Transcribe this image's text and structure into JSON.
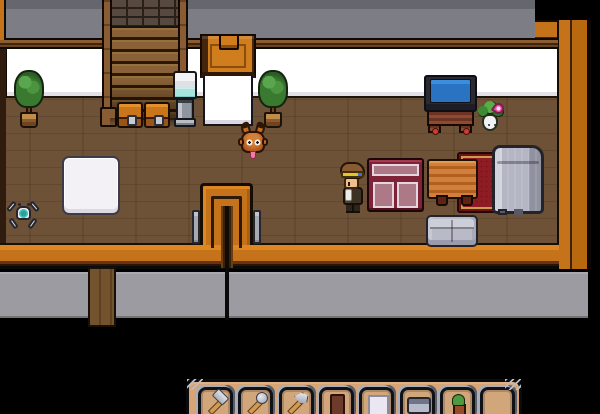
{
  "palette": {
    "void": "#000000",
    "gray_wall_top": "#7d7d85",
    "gray_wall_bottom": "#9b9ba1",
    "orange_wall": "#c4731a",
    "orange_bright": "#de8722",
    "trim_brown": "#6a4523",
    "wall_white": "#ffffff",
    "floor_brown": "#6e5237",
    "tv_screen_blue": "#2a72c2",
    "rug_red": "#8e1c22",
    "rug_gold": "#c99c4e",
    "counter_maroon": "#7f2336",
    "furniture_gray": "#b4b6c4"
  },
  "scene": {
    "objects": [
      {
        "name": "white-rug",
        "type": "white-rug",
        "x": 62,
        "y": 156,
        "w": 58,
        "h": 59,
        "interactable": false
      },
      {
        "name": "red-rug",
        "type": "red-rug",
        "x": 457,
        "y": 152,
        "w": 83,
        "h": 61,
        "interactable": false
      },
      {
        "name": "staircase",
        "type": "stairs",
        "x": 102,
        "y": 0,
        "w": 86,
        "h": 127,
        "interactable": true
      },
      {
        "name": "chest-1",
        "type": "chest",
        "x": 117,
        "y": 102,
        "w": 26,
        "h": 26,
        "interactable": true
      },
      {
        "name": "chest-2",
        "type": "chest",
        "x": 144,
        "y": 102,
        "w": 26,
        "h": 26,
        "interactable": true
      },
      {
        "name": "potted-plant-left",
        "type": "potted-plant",
        "x": 14,
        "y": 70,
        "w": 30,
        "h": 58,
        "interactable": false
      },
      {
        "name": "water-cooler",
        "type": "water-cooler",
        "x": 172,
        "y": 71,
        "w": 26,
        "h": 56,
        "interactable": true
      },
      {
        "name": "north-door",
        "type": "door-top",
        "x": 200,
        "y": 34,
        "w": 56,
        "h": 44,
        "interactable": true
      },
      {
        "name": "dividing-wall-stub",
        "type": "wall-stub",
        "x": 203,
        "y": 76,
        "w": 50,
        "h": 50,
        "interactable": false
      },
      {
        "name": "potted-plant-middle",
        "type": "potted-plant",
        "x": 258,
        "y": 70,
        "w": 30,
        "h": 58,
        "interactable": false
      },
      {
        "name": "television-stand",
        "type": "tv-stand",
        "x": 424,
        "y": 75,
        "w": 53,
        "h": 58,
        "interactable": true
      },
      {
        "name": "plant-monster",
        "type": "plant-monster",
        "x": 478,
        "y": 101,
        "w": 26,
        "h": 32,
        "interactable": true
      },
      {
        "name": "display-counter",
        "type": "display-counter",
        "x": 367,
        "y": 158,
        "w": 57,
        "h": 54,
        "interactable": true
      },
      {
        "name": "wood-table",
        "type": "wood-table",
        "x": 427,
        "y": 159,
        "w": 51,
        "h": 40,
        "interactable": true
      },
      {
        "name": "bed",
        "type": "bed",
        "x": 492,
        "y": 145,
        "w": 52,
        "h": 69,
        "interactable": true
      },
      {
        "name": "sofa",
        "type": "sofa",
        "x": 426,
        "y": 215,
        "w": 52,
        "h": 32,
        "interactable": true
      },
      {
        "name": "entry-alcove-wall",
        "type": "pi-wall",
        "x": 200,
        "y": 183,
        "w": 53,
        "h": 62,
        "interactable": false
      },
      {
        "name": "entry-alcove-channel",
        "type": "wall-channel",
        "x": 221,
        "y": 206,
        "w": 12,
        "h": 62,
        "interactable": false
      },
      {
        "name": "wall-divider-line",
        "type": "black-line",
        "x": 225,
        "y": 266,
        "w": 4,
        "h": 54,
        "interactable": false
      },
      {
        "name": "pillar-left",
        "type": "pillar",
        "x": 192,
        "y": 210,
        "w": 8,
        "h": 34,
        "interactable": false
      },
      {
        "name": "pillar-right",
        "type": "pillar",
        "x": 253,
        "y": 210,
        "w": 8,
        "h": 34,
        "interactable": false
      },
      {
        "name": "south-door",
        "type": "bottom-door",
        "x": 88,
        "y": 267,
        "w": 28,
        "h": 60,
        "interactable": true
      },
      {
        "name": "robot-pet",
        "type": "robot-pet",
        "x": 8,
        "y": 198,
        "w": 30,
        "h": 36,
        "interactable": true
      },
      {
        "name": "crab-pet",
        "type": "crab-pet",
        "x": 238,
        "y": 122,
        "w": 30,
        "h": 38,
        "interactable": true
      },
      {
        "name": "player-character",
        "type": "player",
        "x": 339,
        "y": 162,
        "w": 28,
        "h": 52,
        "interactable": true
      }
    ]
  },
  "hotbar": {
    "slots": [
      {
        "item": "hammer"
      },
      {
        "item": "shovel"
      },
      {
        "item": "axe"
      },
      {
        "item": "door"
      },
      {
        "item": "white-panel"
      },
      {
        "item": "sofa"
      },
      {
        "item": "potted-plant"
      },
      {
        "item": null
      }
    ]
  }
}
